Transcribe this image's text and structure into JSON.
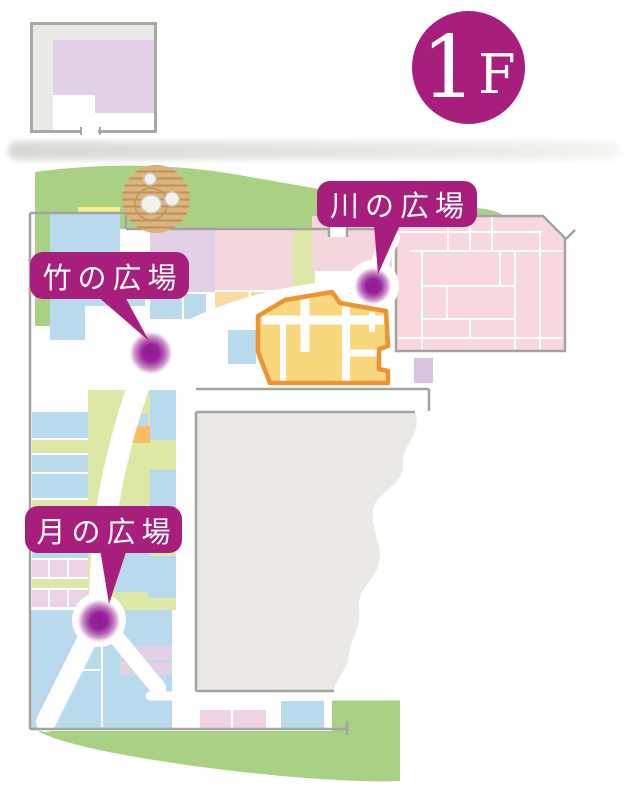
{
  "floor_badge": {
    "digit": "1",
    "letter": "F"
  },
  "plazas": [
    {
      "name": "川の広場"
    },
    {
      "name": "竹の広場"
    },
    {
      "name": "月の広場"
    }
  ],
  "icons": {
    "zen_garden": "raked-sand-circle-with-stones",
    "plaza_marker": "purple-glow-dot"
  },
  "colors": {
    "accent_magenta": "#a81e7c",
    "marker_purple": "#8e1b90",
    "grass_green": "#a9d184",
    "room_blue": "#b9d9ed",
    "room_pink": "#f6d8de",
    "room_lavender": "#e2d1e6",
    "room_yellowgreen": "#dde7a6",
    "room_yellow": "#f6ef8e",
    "room_peach": "#fbdba4",
    "building_fill": "#f8d77d",
    "building_outline": "#ee9331",
    "courtyard_gray": "#eae9e5",
    "wall_gray": "#a3a39f"
  }
}
